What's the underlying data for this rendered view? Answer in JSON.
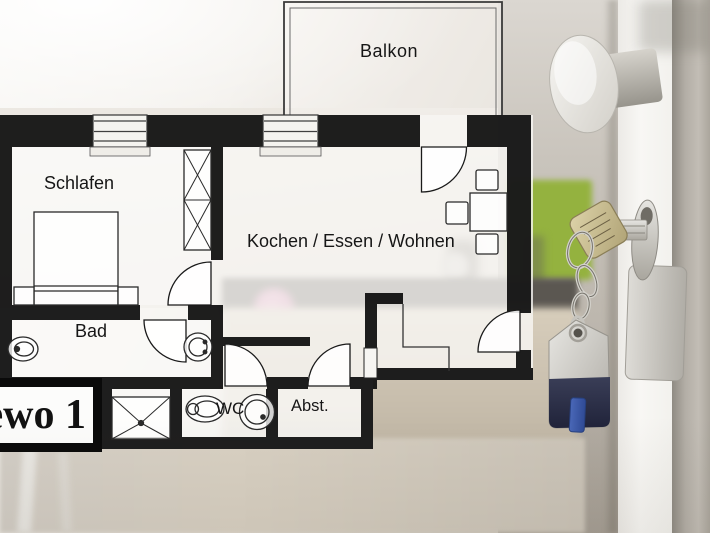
{
  "plan": {
    "type": "floorplan-overlay",
    "rooms": [
      {
        "id": "balkon",
        "label": "Balkon"
      },
      {
        "id": "schlafen",
        "label": "Schlafen"
      },
      {
        "id": "kochen-essen-wohnen",
        "label": "Kochen / Essen / Wohnen"
      },
      {
        "id": "bad",
        "label": "Bad"
      },
      {
        "id": "wc",
        "label": "WC"
      },
      {
        "id": "abstellraum",
        "label": "Abst."
      }
    ],
    "sign": {
      "label": "ewo 1"
    },
    "furniture_icons": [
      "bed-icon",
      "nightstand-icon",
      "wardrobe-icon",
      "dining-table-icon",
      "chair-icon",
      "toilet-icon",
      "sink-icon",
      "washbasin-icon",
      "shower-tray-icon",
      "door-swing-icon",
      "window-icon",
      "balcony-railing-icon"
    ],
    "colors": {
      "wall": "#0d0d0d",
      "floor_overlay": "#faf9f6",
      "line": "#2a2a2a",
      "label_text": "#161616"
    }
  },
  "photo": {
    "object_icons": [
      "door-knob-icon",
      "key-icon",
      "key-chain-icon",
      "key-fob-icon",
      "lock-cylinder-icon",
      "lock-plate-icon",
      "green-wall-panel",
      "kitchen-counter",
      "flower-bouquet",
      "white-door"
    ],
    "colors": {
      "green_panel": "#94b23f",
      "counter_dark": "#5b5751",
      "door_white": "#f6f5f2",
      "frame_grey": "#aba69d",
      "key_brass": "#cfc49c",
      "fob_navy": "#2b2e47",
      "fob_tab_blue": "#3f5fae",
      "metal_silver": "#d8d6d1"
    }
  }
}
